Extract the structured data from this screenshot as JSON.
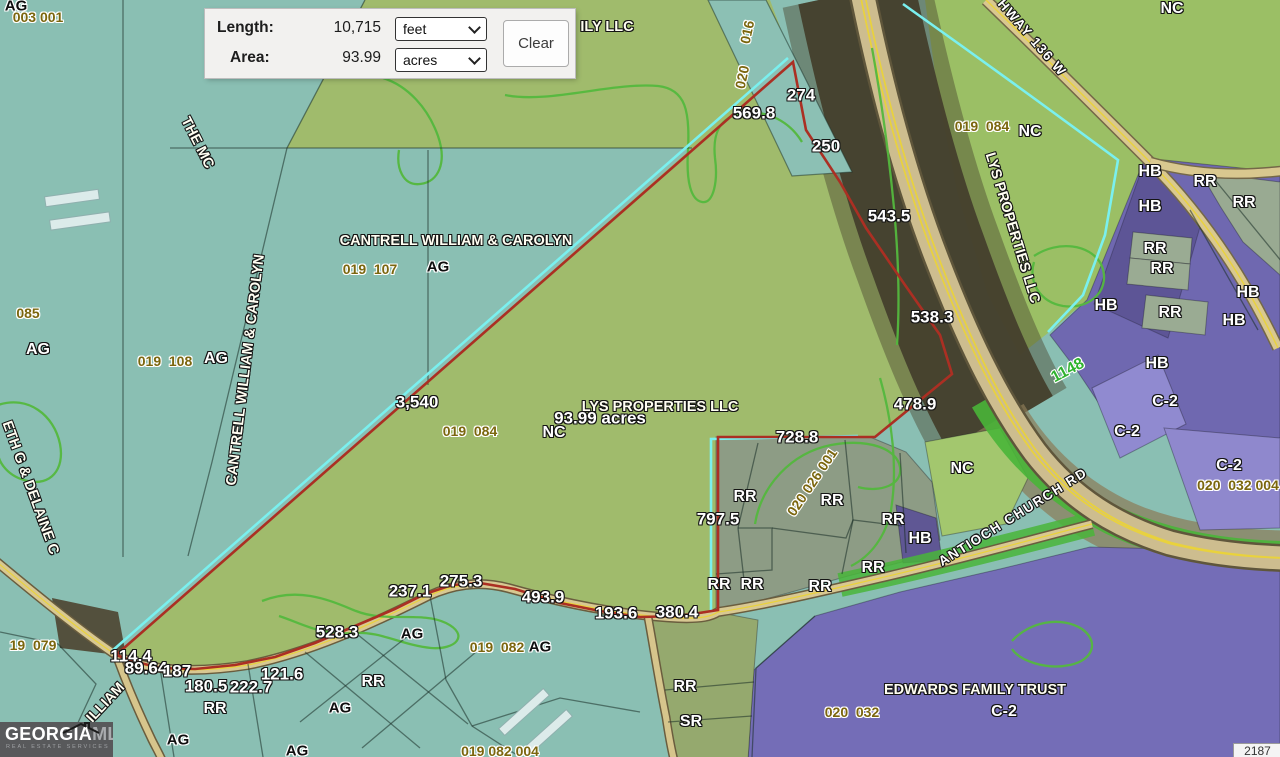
{
  "measure_panel": {
    "length_label": "Length:",
    "length_value": "10,715",
    "length_unit": "feet",
    "area_label": "Area:",
    "area_value": "93.99",
    "area_unit": "acres",
    "clear_label": "Clear"
  },
  "logo": {
    "brand_primary": "GEORGIA",
    "brand_secondary": "MLS",
    "tagline": "REAL ESTATE SERVICES"
  },
  "scale_box": {
    "text": "2187"
  },
  "map": {
    "colors": {
      "measured_boundary_red": "#ab2f23",
      "selection_cyan": "#7af0ef",
      "parcel_green": "#a0bb6c",
      "base_teal": "#8abfb3",
      "zone_purple": "#746db7",
      "zone_rr_gray_green": "#8d9c85",
      "road_tan": "#d9c88f",
      "contour_green": "#54b83e",
      "road_number_green": "#2fb32f"
    },
    "labels": [
      {
        "t": "AG",
        "x": 16,
        "y": 6,
        "s": "zd"
      },
      {
        "t": "003 001",
        "x": 38,
        "y": 17,
        "s": "p"
      },
      {
        "t": "ILY LLC",
        "x": 607,
        "y": 27,
        "s": "o"
      },
      {
        "t": "016",
        "x": 747,
        "y": 32,
        "s": "p",
        "r": -78
      },
      {
        "t": "020",
        "x": 742,
        "y": 77,
        "s": "p",
        "r": -78
      },
      {
        "t": "NC",
        "x": 1172,
        "y": 9,
        "s": "z"
      },
      {
        "t": "HWAY 136 W",
        "x": 1032,
        "y": 38,
        "s": "rd",
        "r": 49
      },
      {
        "t": "274",
        "x": 801,
        "y": 95,
        "s": "m"
      },
      {
        "t": "569.8",
        "x": 754,
        "y": 113,
        "s": "m"
      },
      {
        "t": "250",
        "x": 826,
        "y": 146,
        "s": "m"
      },
      {
        "t": "019  084",
        "x": 982,
        "y": 126,
        "s": "p"
      },
      {
        "t": "NC",
        "x": 1030,
        "y": 132,
        "s": "z"
      },
      {
        "t": "THE MC",
        "x": 197,
        "y": 143,
        "s": "o",
        "r": 63
      },
      {
        "t": "HB",
        "x": 1150,
        "y": 172,
        "s": "z"
      },
      {
        "t": "RR",
        "x": 1205,
        "y": 182,
        "s": "z"
      },
      {
        "t": "RR",
        "x": 1244,
        "y": 203,
        "s": "z"
      },
      {
        "t": "HB",
        "x": 1150,
        "y": 207,
        "s": "z"
      },
      {
        "t": "543.5",
        "x": 889,
        "y": 216,
        "s": "m"
      },
      {
        "t": "LYS PROPERTIES LLC",
        "x": 1012,
        "y": 228,
        "s": "o",
        "r": 73
      },
      {
        "t": "CANTRELL WILLIAM & CAROLYN",
        "x": 456,
        "y": 241,
        "s": "o"
      },
      {
        "t": "RR",
        "x": 1155,
        "y": 249,
        "s": "z"
      },
      {
        "t": "019  107",
        "x": 370,
        "y": 269,
        "s": "p"
      },
      {
        "t": "AG",
        "x": 438,
        "y": 267,
        "s": "zd"
      },
      {
        "t": "RR",
        "x": 1162,
        "y": 269,
        "s": "z"
      },
      {
        "t": "HB",
        "x": 1248,
        "y": 293,
        "s": "z"
      },
      {
        "t": "HB",
        "x": 1106,
        "y": 306,
        "s": "z"
      },
      {
        "t": "085",
        "x": 28,
        "y": 313,
        "s": "p"
      },
      {
        "t": "RR",
        "x": 1170,
        "y": 313,
        "s": "z"
      },
      {
        "t": "538.3",
        "x": 932,
        "y": 317,
        "s": "m"
      },
      {
        "t": "HB",
        "x": 1234,
        "y": 321,
        "s": "z"
      },
      {
        "t": "AG",
        "x": 38,
        "y": 350,
        "s": "z"
      },
      {
        "t": "019  108",
        "x": 165,
        "y": 361,
        "s": "p"
      },
      {
        "t": "AG",
        "x": 216,
        "y": 359,
        "s": "z"
      },
      {
        "t": "HB",
        "x": 1157,
        "y": 364,
        "s": "z"
      },
      {
        "t": "1148",
        "x": 1068,
        "y": 371,
        "s": "rn",
        "r": -28
      },
      {
        "t": "CANTRELL WILLIAM & CAROLYN",
        "x": 246,
        "y": 370,
        "s": "o",
        "r": -83
      },
      {
        "t": "3,540",
        "x": 417,
        "y": 402,
        "s": "m"
      },
      {
        "t": "C-2",
        "x": 1165,
        "y": 402,
        "s": "z"
      },
      {
        "t": "478.9",
        "x": 915,
        "y": 404,
        "s": "m"
      },
      {
        "t": "LYS PROPERTIES LLC",
        "x": 660,
        "y": 407,
        "s": "o"
      },
      {
        "t": "93.99 acres",
        "x": 600,
        "y": 418,
        "s": "m"
      },
      {
        "t": "019  084",
        "x": 470,
        "y": 431,
        "s": "p"
      },
      {
        "t": "NC",
        "x": 554,
        "y": 433,
        "s": "z"
      },
      {
        "t": "C-2",
        "x": 1127,
        "y": 432,
        "s": "z"
      },
      {
        "t": "728.8",
        "x": 797,
        "y": 437,
        "s": "m"
      },
      {
        "t": "C-2",
        "x": 1229,
        "y": 466,
        "s": "z"
      },
      {
        "t": "NC",
        "x": 962,
        "y": 469,
        "s": "z"
      },
      {
        "t": "020 026 001",
        "x": 812,
        "y": 482,
        "s": "p",
        "r": -56
      },
      {
        "t": "020  032 004",
        "x": 1238,
        "y": 485,
        "s": "p"
      },
      {
        "t": "ETH G & DELAINE C",
        "x": 30,
        "y": 488,
        "s": "o",
        "r": 70
      },
      {
        "t": "RR",
        "x": 745,
        "y": 497,
        "s": "z"
      },
      {
        "t": "RR",
        "x": 832,
        "y": 501,
        "s": "z"
      },
      {
        "t": "ANTIOCH CHURCH RD",
        "x": 1013,
        "y": 517,
        "s": "rd",
        "r": -32
      },
      {
        "t": "797.5",
        "x": 718,
        "y": 519,
        "s": "m"
      },
      {
        "t": "RR",
        "x": 893,
        "y": 520,
        "s": "z"
      },
      {
        "t": "HB",
        "x": 920,
        "y": 539,
        "s": "z"
      },
      {
        "t": "RR",
        "x": 873,
        "y": 568,
        "s": "z"
      },
      {
        "t": "275.3",
        "x": 461,
        "y": 581,
        "s": "m"
      },
      {
        "t": "RR",
        "x": 719,
        "y": 585,
        "s": "z"
      },
      {
        "t": "RR",
        "x": 752,
        "y": 585,
        "s": "z"
      },
      {
        "t": "RR",
        "x": 820,
        "y": 587,
        "s": "z"
      },
      {
        "t": "237.1",
        "x": 410,
        "y": 591,
        "s": "m"
      },
      {
        "t": "493.9",
        "x": 543,
        "y": 597,
        "s": "m"
      },
      {
        "t": "193.6",
        "x": 616,
        "y": 613,
        "s": "m"
      },
      {
        "t": "380.4",
        "x": 677,
        "y": 612,
        "s": "m"
      },
      {
        "t": "528.3",
        "x": 337,
        "y": 632,
        "s": "m"
      },
      {
        "t": "AG",
        "x": 412,
        "y": 634,
        "s": "zd"
      },
      {
        "t": "19  079",
        "x": 33,
        "y": 645,
        "s": "p"
      },
      {
        "t": "019  082",
        "x": 497,
        "y": 647,
        "s": "p"
      },
      {
        "t": "AG",
        "x": 540,
        "y": 647,
        "s": "zd"
      },
      {
        "t": "114.4",
        "x": 131,
        "y": 656,
        "s": "m"
      },
      {
        "t": "89.64",
        "x": 146,
        "y": 668,
        "s": "m"
      },
      {
        "t": "187",
        "x": 177,
        "y": 671,
        "s": "m"
      },
      {
        "t": "121.6",
        "x": 282,
        "y": 674,
        "s": "m"
      },
      {
        "t": "180.5",
        "x": 206,
        "y": 686,
        "s": "m"
      },
      {
        "t": "222.7",
        "x": 251,
        "y": 687,
        "s": "m"
      },
      {
        "t": "RR",
        "x": 373,
        "y": 682,
        "s": "z"
      },
      {
        "t": "RR",
        "x": 685,
        "y": 687,
        "s": "z"
      },
      {
        "t": "EDWARDS FAMILY TRUST",
        "x": 975,
        "y": 690,
        "s": "o"
      },
      {
        "t": "ILLIAM",
        "x": 106,
        "y": 703,
        "s": "o",
        "r": -47
      },
      {
        "t": "AG",
        "x": 340,
        "y": 708,
        "s": "zd"
      },
      {
        "t": "RR",
        "x": 215,
        "y": 709,
        "s": "z"
      },
      {
        "t": "020  032",
        "x": 852,
        "y": 712,
        "s": "p"
      },
      {
        "t": "C-2",
        "x": 1004,
        "y": 712,
        "s": "z"
      },
      {
        "t": "SR",
        "x": 691,
        "y": 722,
        "s": "z"
      },
      {
        "t": "AG",
        "x": 178,
        "y": 740,
        "s": "zd"
      },
      {
        "t": "019 082 004",
        "x": 500,
        "y": 751,
        "s": "p"
      },
      {
        "t": "AG",
        "x": 297,
        "y": 751,
        "s": "zd"
      }
    ]
  }
}
